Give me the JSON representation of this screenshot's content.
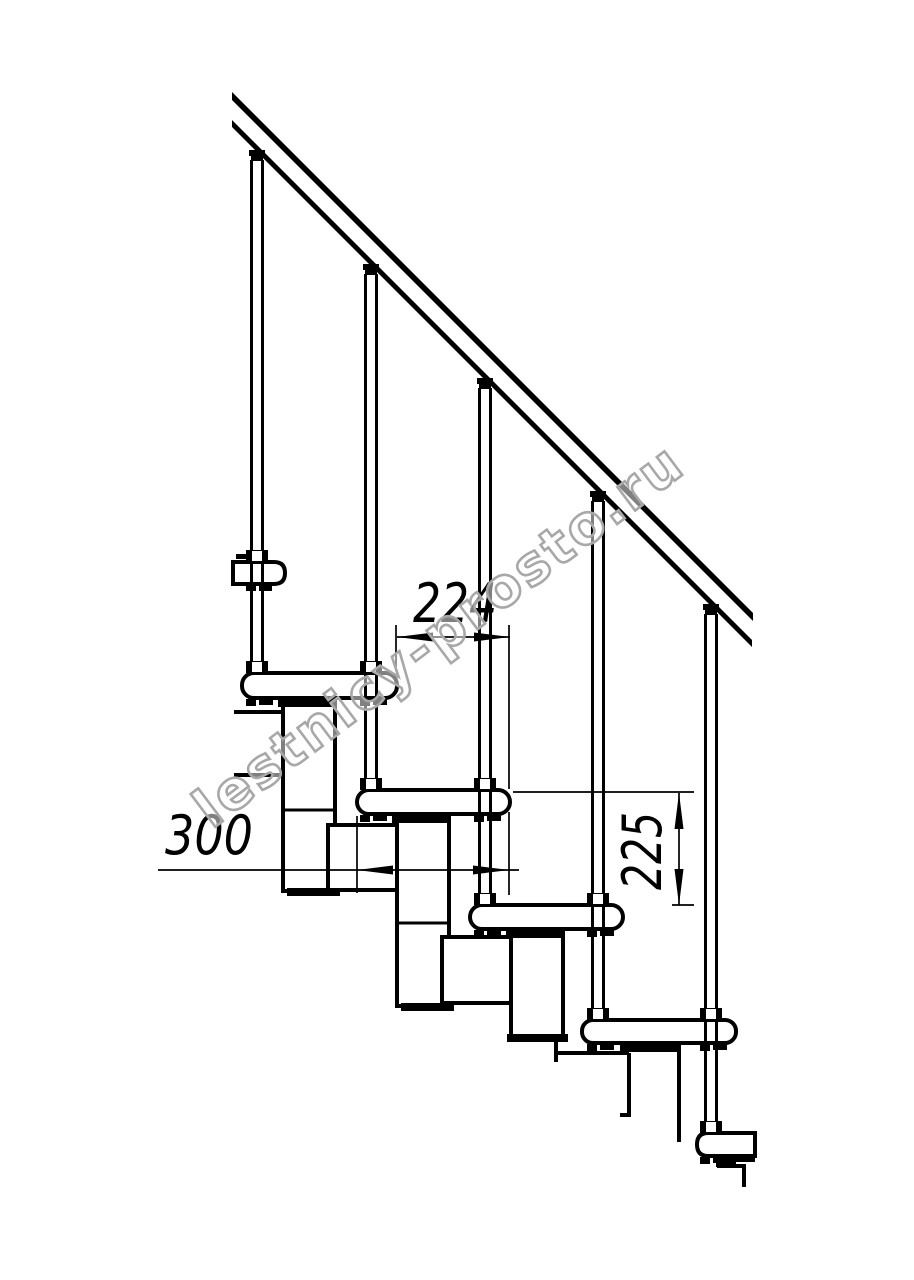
{
  "page": {
    "background_color": "#ffffff",
    "ink_color": "#000000",
    "description": "Side-view technical drawing of a modular staircase with railing"
  },
  "drawing": {
    "dimensions": {
      "step_offset": "224",
      "tread_depth": "300",
      "rise_height": "225"
    },
    "watermark": {
      "text": "lestnicy-prosto.ru",
      "color": "#a8a8a8"
    },
    "parts_visible": {
      "balusters": 5,
      "treads": 6,
      "handrail": 1
    }
  }
}
